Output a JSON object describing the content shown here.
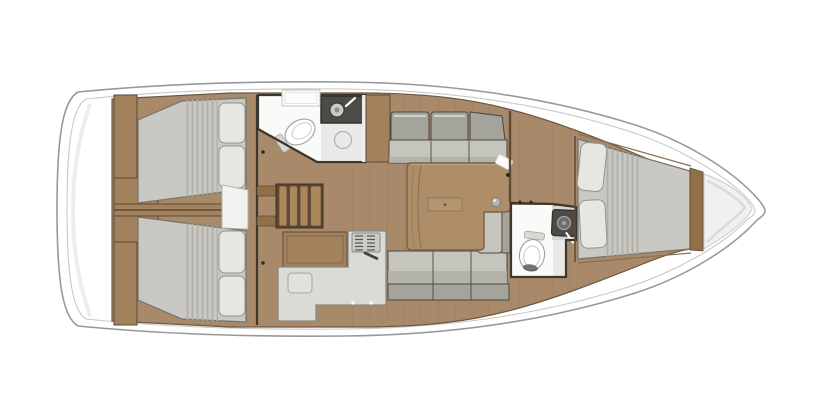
{
  "canvas": {
    "width": 840,
    "height": 420,
    "background": "#ffffff"
  },
  "colors": {
    "hull_fill": "#ffffff",
    "hull_line": "#98989a",
    "hull_inner": "#c9c9c6",
    "transom_shade": "#ededeb",
    "floor": "#a8896a",
    "floor_seam": "#6b5a45",
    "wood_panel": "#a1825c",
    "wood_step": "#aa885c",
    "wood_dark": "#8f7048",
    "trim": "#5f4a34",
    "wall": "#3c362e",
    "mattress": "#c9c8c2",
    "mattress_stripe": "#b1b0a8",
    "mattress_edge": "#75746e",
    "pillow": "#e6e6e3",
    "pillow_edge": "#94948f",
    "seat": "#c6c5bd",
    "seat_shade": "#b0afa7",
    "seatback": "#a5a49c",
    "cushion_edge": "#4a4842",
    "cushion_highlight": "#d3d2cb",
    "counter": "#dadad6",
    "counter_edge": "#8a8a85",
    "bath_white": "#fafaf9",
    "bath_floor": "#e9e9e7",
    "shower_pan": "#4c4b47",
    "fixture": "#ffffff",
    "fixture_edge": "#a0a09b",
    "table_top": "#ad8e68",
    "table_edge": "#7c6244",
    "table_inset": "#b4956f",
    "locker": "#f0f0ee",
    "locker_shade": "#dadad7"
  },
  "features": [
    {
      "id": "hull",
      "desc": "sailing-yacht-hull-outline-bow-right"
    },
    {
      "id": "anchor-locker",
      "desc": "bow-locker"
    },
    {
      "id": "forward-cabin",
      "desc": "v-berth-double-bed-2-pillows"
    },
    {
      "id": "forward-head",
      "desc": "toilet-and-sink"
    },
    {
      "id": "saloon",
      "desc": "settees-both-sides-with-table"
    },
    {
      "id": "galley",
      "desc": "l-shaped-counter-stove-sink"
    },
    {
      "id": "aft-head",
      "desc": "shower-sink-toilet"
    },
    {
      "id": "companionway",
      "desc": "stairs-4-steps-with-rails"
    },
    {
      "id": "aft-cabin-port",
      "desc": "double-bed-2-pillows"
    },
    {
      "id": "aft-cabin-starboard",
      "desc": "double-bed-2-pillows"
    }
  ]
}
